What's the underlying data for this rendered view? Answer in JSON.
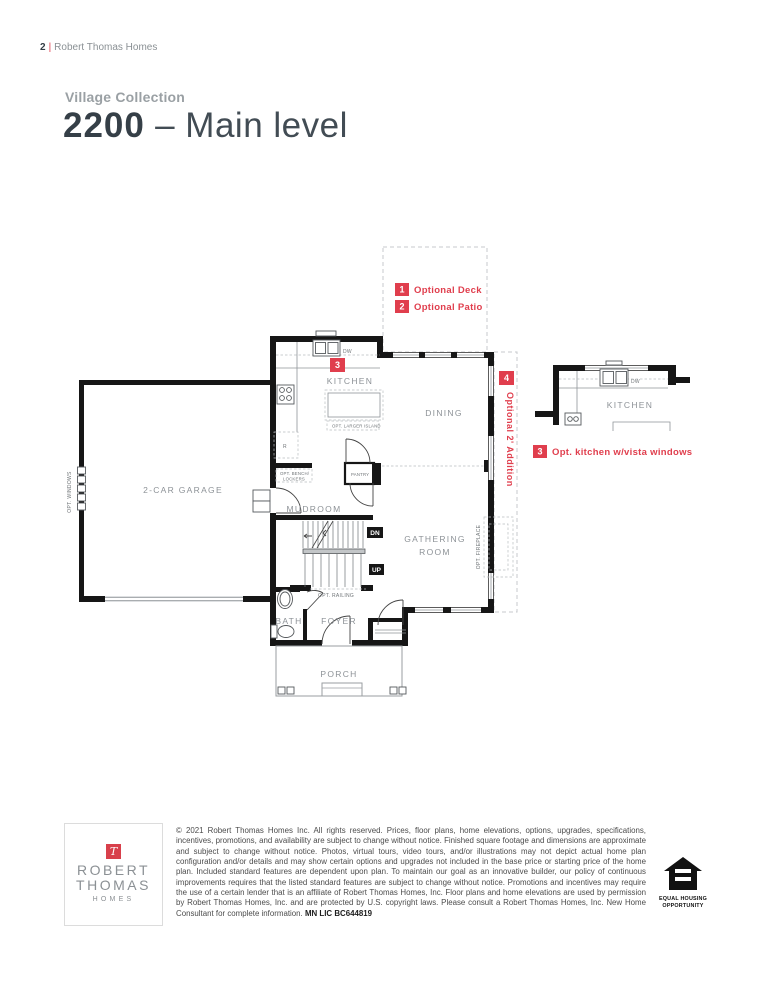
{
  "header": {
    "page_number": "2",
    "divider": "|",
    "brand": "Robert Thomas Homes"
  },
  "title": {
    "collection": "Village Collection",
    "model": "2200",
    "rest": "– Main level"
  },
  "colors": {
    "accent_red": "#e03e4d",
    "title_dark": "#353f47",
    "label_gray": "#8d9297",
    "wall_black": "#161616"
  },
  "plan": {
    "rooms": {
      "garage": "2-CAR GARAGE",
      "kitchen": "KITCHEN",
      "dining": "DINING",
      "mudroom": "MUDROOM",
      "gathering1": "GATHERING",
      "gathering2": "ROOM",
      "bath": "BATH",
      "foyer": "FOYER",
      "porch": "PORCH",
      "pantry": "PANTRY"
    },
    "annotations": {
      "opt_windows": "OPT. WINDOWS",
      "opt_fireplace": "OPT. FIREPLACE",
      "opt_railing": "OPT. RAILING",
      "opt_bench1": "OPT. BENCH/",
      "opt_bench2": "LOCKERS",
      "opt_larger_island": "OPT. LARGER ISLAND",
      "dw": "DW",
      "fridge": "R",
      "dn": "DN",
      "up": "UP",
      "optional_addition": "Optional 2' Addition"
    },
    "legend": [
      {
        "num": "1",
        "label": "Optional Deck"
      },
      {
        "num": "2",
        "label": "Optional Patio"
      }
    ],
    "badge3": "3",
    "badge4": "4",
    "inset": {
      "kitchen": "KITCHEN",
      "dw": "DW",
      "note_num": "3",
      "note": "Opt. kitchen w/vista windows"
    }
  },
  "footer": {
    "logo": {
      "monogram": "T",
      "line1": "ROBERT",
      "line2": "THOMAS",
      "line3": "HOMES"
    },
    "legal": "© 2021 Robert Thomas Homes Inc. All rights reserved. Prices, floor plans, home elevations, options, upgrades, specifications, incentives, promotions, and availability are subject to change without notice. Finished square footage and dimensions are approximate and subject to change without notice. Photos, virtual tours, video tours, and/or illustrations may not depict actual home plan configuration and/or details and may show certain options and upgrades not included in the base price or starting price of the home plan. Included standard features are dependent upon plan. To maintain our goal as an innovative builder, our policy of continuous improvements requires that the listed standard features are subject to change without notice. Promotions and incentives may require the use of a certain lender that is an affiliate of Robert Thomas Homes, Inc. Floor plans and home elevations are used by permission by Robert Thomas Homes, Inc. and are protected by U.S. copyright laws. Please consult a Robert Thomas Homes, Inc. New Home Consultant for complete information. ",
    "license": "MN LIC BC644819",
    "eho": {
      "line1": "EQUAL HOUSING",
      "line2": "OPPORTUNITY"
    }
  }
}
